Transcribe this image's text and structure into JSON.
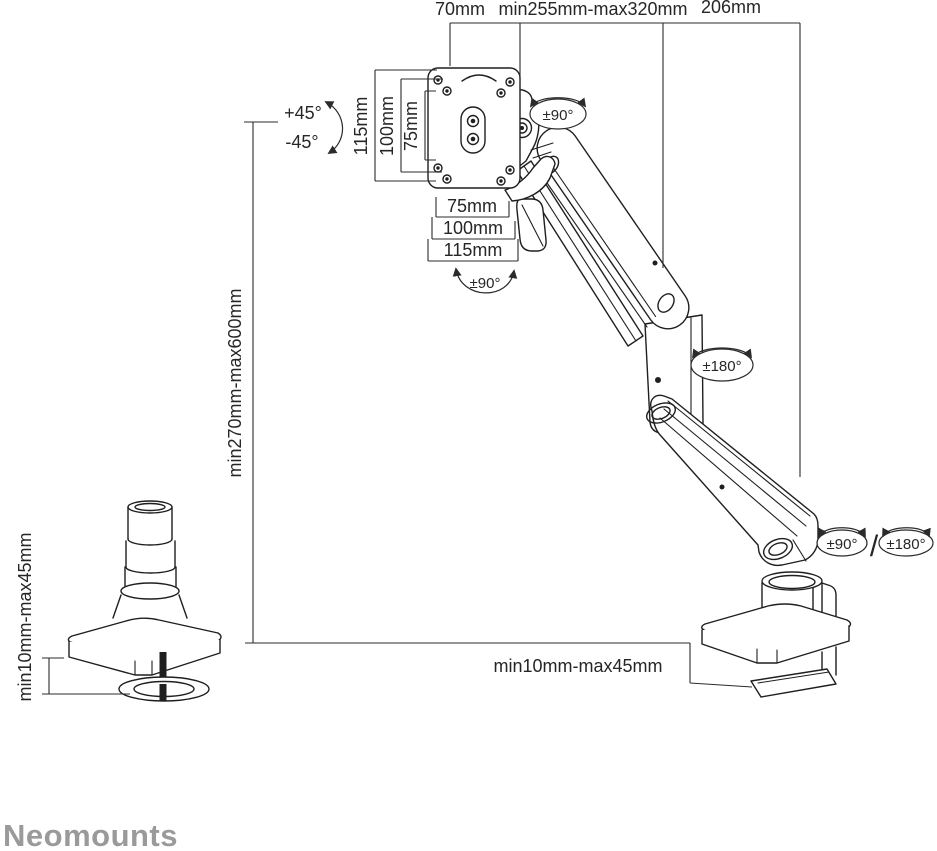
{
  "branding": {
    "logo_text": "Neomounts"
  },
  "colors": {
    "line": "#262626",
    "drawing": "#1f1f1f",
    "logo": "#9a9a9a",
    "background": "#ffffff"
  },
  "dimensions": {
    "top": {
      "vesa_offset": "70mm",
      "arm_extension": "min255mm-max320mm",
      "rear_arm": "206mm"
    },
    "height_range": "min270mm-max600mm",
    "vesa_vertical": {
      "v115": "115mm",
      "v100": "100mm",
      "v75": "75mm"
    },
    "vesa_horizontal": {
      "h75": "75mm",
      "h100": "100mm",
      "h115": "115mm"
    },
    "grommet_clamp_range": "min10mm-max45mm",
    "desk_clamp_range": "min10mm-max45mm"
  },
  "rotations": {
    "tilt_up": "+45°",
    "tilt_down": "-45°",
    "head_swivel": "±90°",
    "vesa_rotate": "±90°",
    "elbow_rotation": "±180°",
    "base_rotation_a": "±90°",
    "slash": "/",
    "base_rotation_b": "±180°"
  }
}
